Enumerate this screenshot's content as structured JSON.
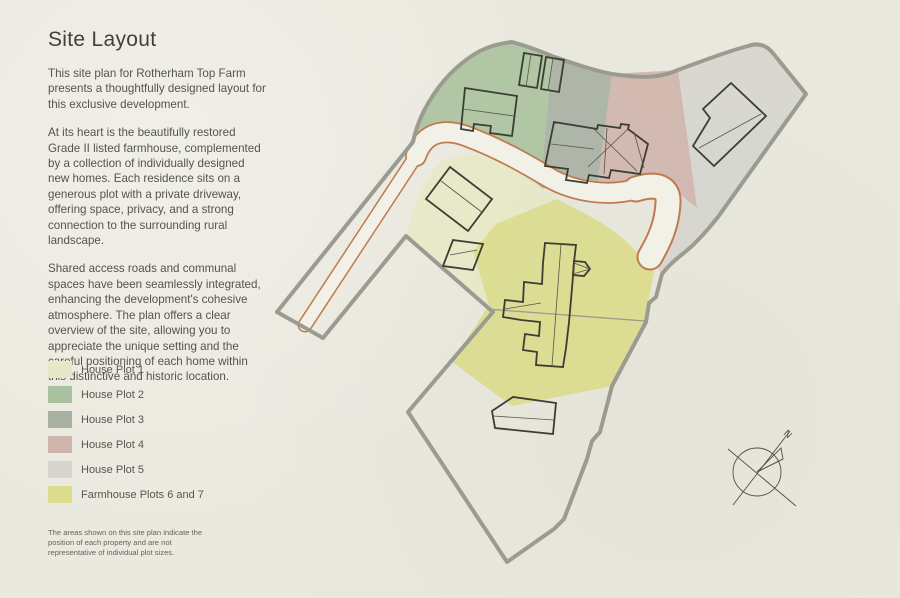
{
  "header": {
    "title": "Site Layout"
  },
  "intro": {
    "paragraphs": [
      "This site plan for Rotherham Top Farm presents a thoughtfully designed layout for this exclusive development.",
      "At its heart is the beautifully restored Grade II listed farmhouse, complemented by a collection of individually designed new homes. Each residence sits on a generous plot with a private driveway, offering space, privacy, and a strong connection to the surrounding rural landscape.",
      "Shared access roads and communal spaces have been seamlessly integrated, enhancing the development's cohesive atmosphere. The plan offers a clear overview of the site, allowing you to appreciate the unique setting and the careful positioning of each home within this distinctive and historic location."
    ]
  },
  "legend": {
    "items": [
      {
        "key": "plot1",
        "label": "House Plot 1",
        "color": "#e7e8c7"
      },
      {
        "key": "plot2",
        "label": "House Plot 2",
        "color": "#aac29f"
      },
      {
        "key": "plot3",
        "label": "House Plot 3",
        "color": "#a9b1a4"
      },
      {
        "key": "plot4",
        "label": "House Plot 4",
        "color": "#d0b5ac"
      },
      {
        "key": "plot5",
        "label": "House Plot 5",
        "color": "#d6d6cf"
      },
      {
        "key": "plot67",
        "label": "Farmhouse Plots 6 and 7",
        "color": "#dbdc8d"
      }
    ]
  },
  "disclaimer": {
    "text": "The areas shown on this site plan indicate the position of each property and are not representative of individual plot sizes."
  },
  "map": {
    "compass_label": "N",
    "colors": {
      "boundary": "#9b9b90",
      "divider": "#9b9b90",
      "road_edge": "#c07a4c",
      "road_fill": "#f1f1e8",
      "building": "#3d3d34",
      "building_detail": "#55554a",
      "compass": "#4f4f46"
    }
  }
}
